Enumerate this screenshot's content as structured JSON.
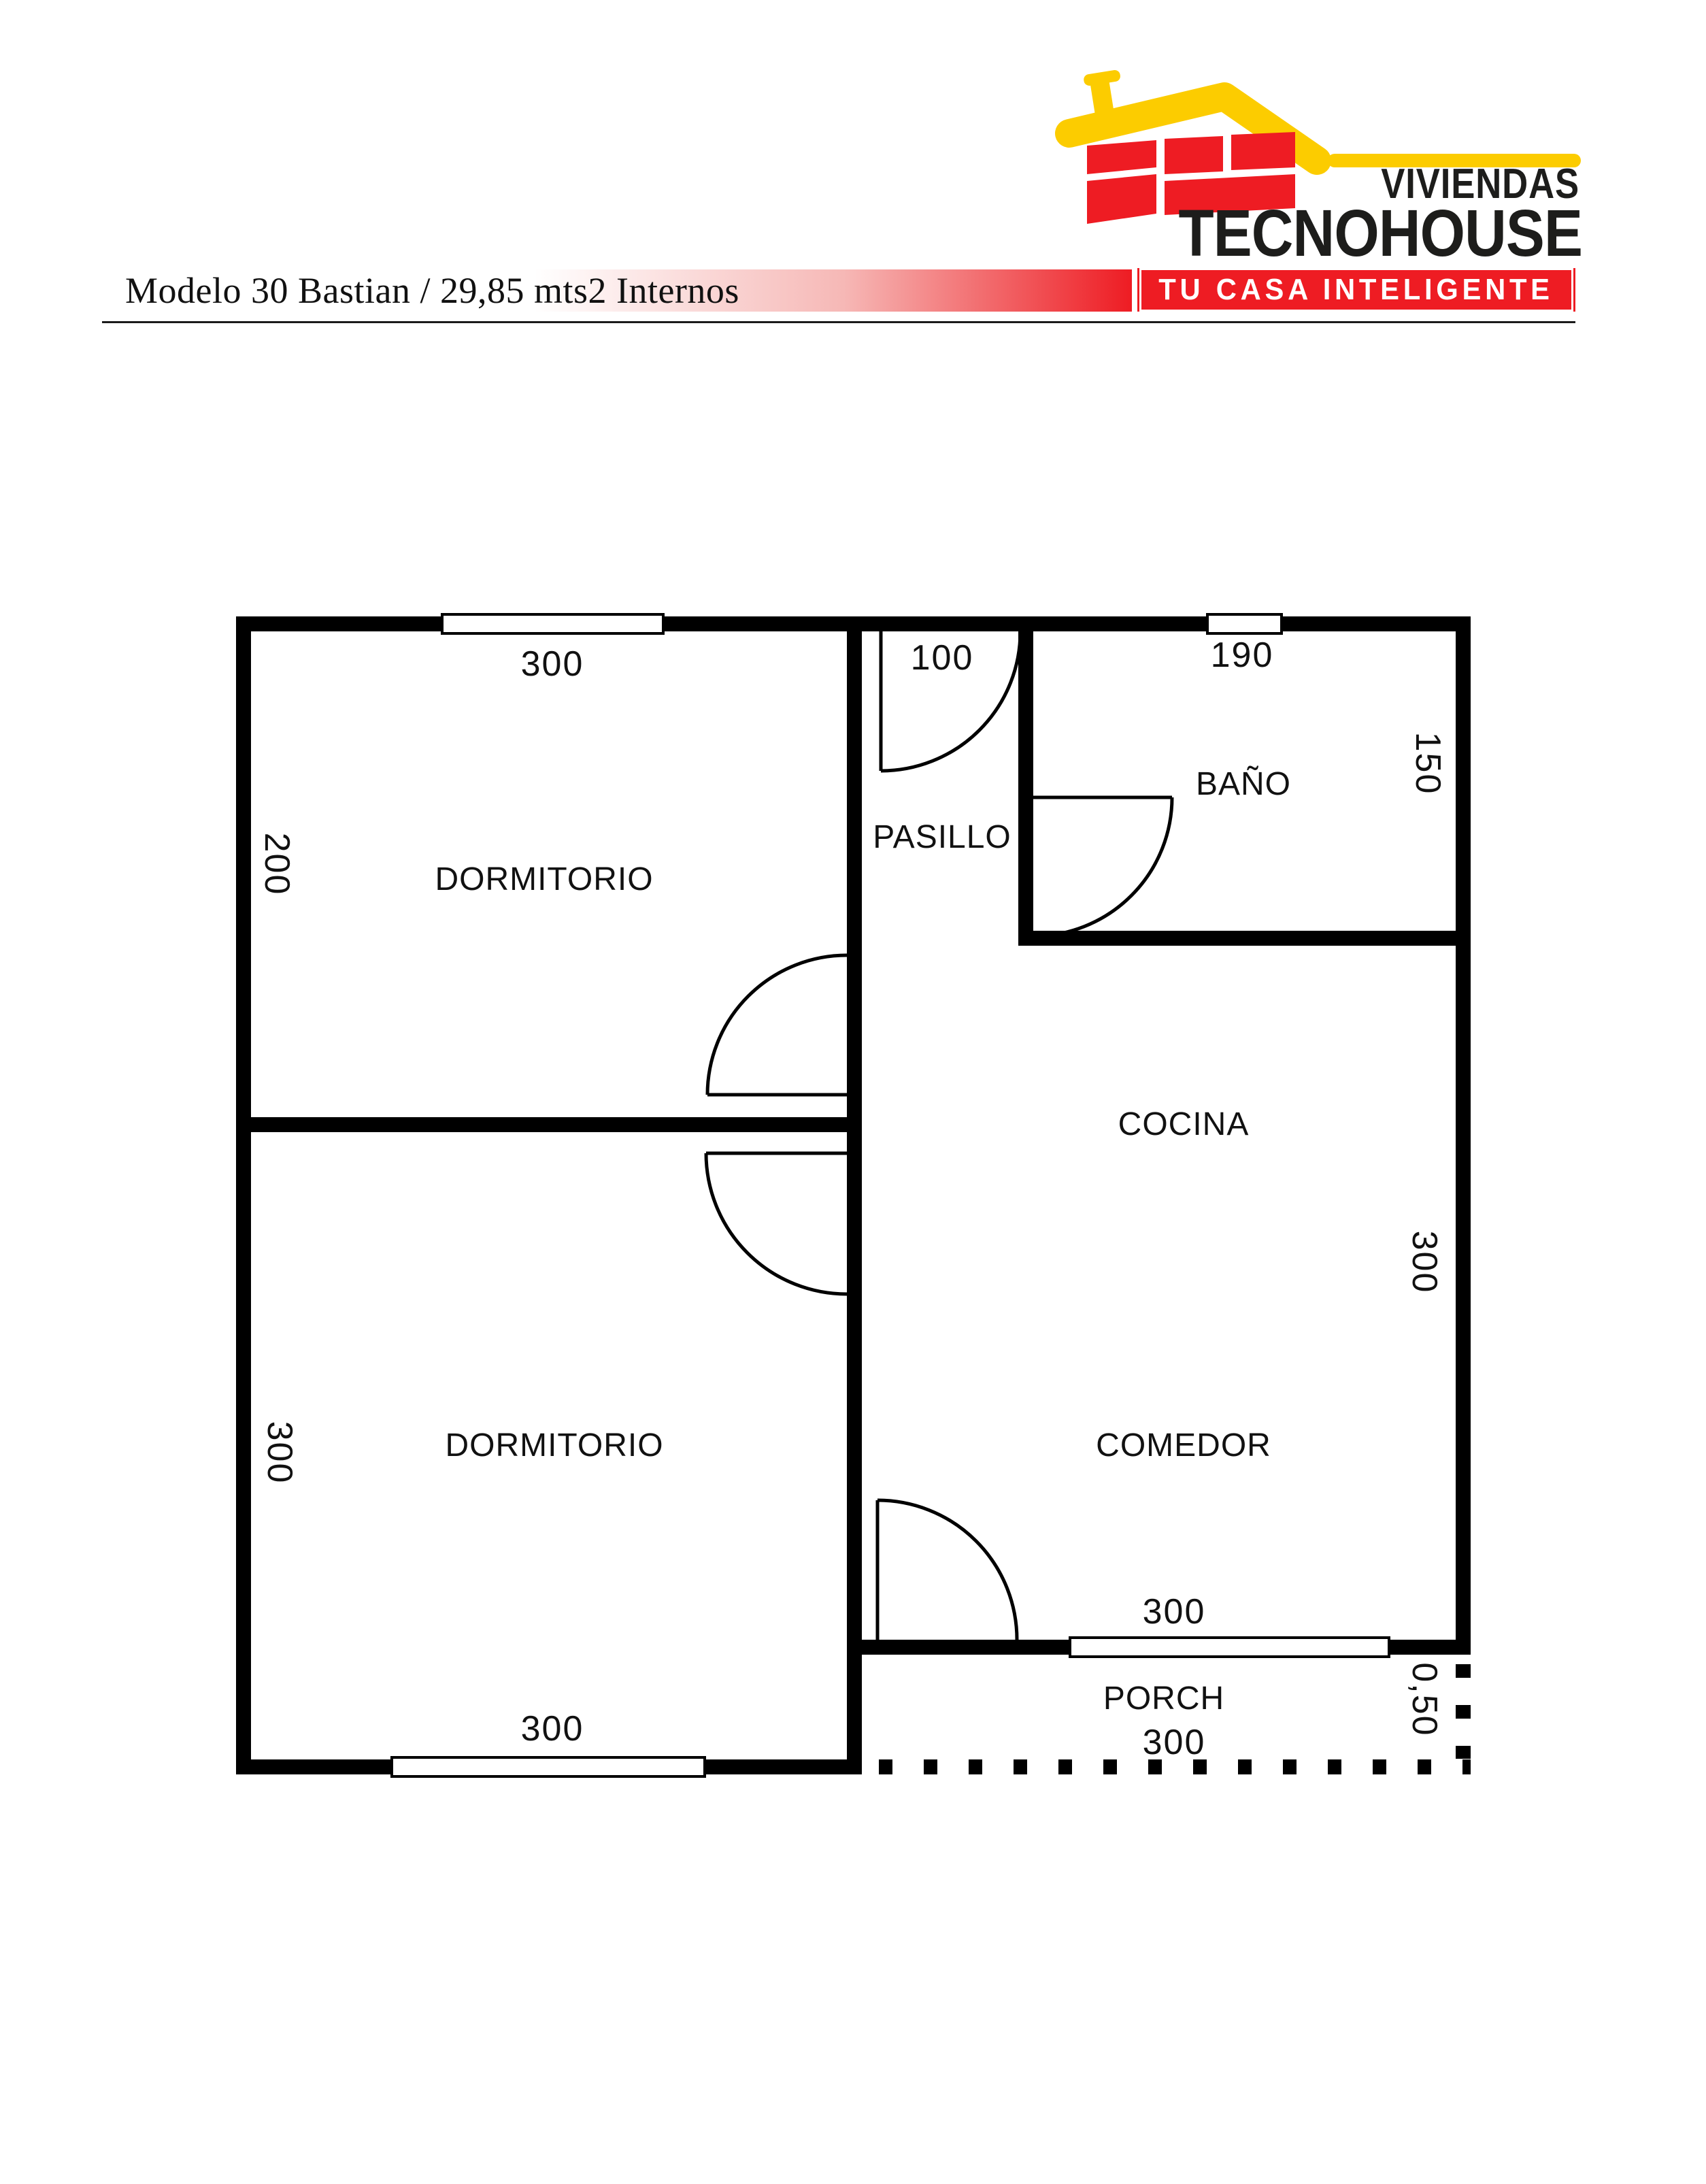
{
  "header": {
    "title": "Modelo 30 Bastian / 29,85 mts2 Internos",
    "logo": {
      "brand_top": "VIVIENDAS",
      "brand_main": "TECNOHOUSE",
      "slogan": "TU CASA INTELIGENTE",
      "icon": "house-roof-bricks-icon"
    },
    "colors": {
      "red": "#ee1c23",
      "yellow": "#fccc00",
      "text_black": "#1d1d1b"
    }
  },
  "floorplan": {
    "wall_color": "#000000",
    "room_labels": {
      "dormitorio_top": "DORMITORIO",
      "pasillo": "PASILLO",
      "bano": "BAÑO",
      "cocina": "COCINA",
      "dormitorio_bottom": "DORMITORIO",
      "comedor": "COMEDOR",
      "porch": "PORCH"
    },
    "dimensions": {
      "dorm_top_width": "300",
      "dorm_top_height": "200",
      "pasillo_width": "100",
      "bano_width": "190",
      "bano_height": "150",
      "cocina_comedor_height": "300",
      "dorm_bottom_height": "300",
      "dorm_bottom_width": "300",
      "comedor_width": "300",
      "porch_width": "300",
      "porch_depth": "0,50"
    }
  }
}
